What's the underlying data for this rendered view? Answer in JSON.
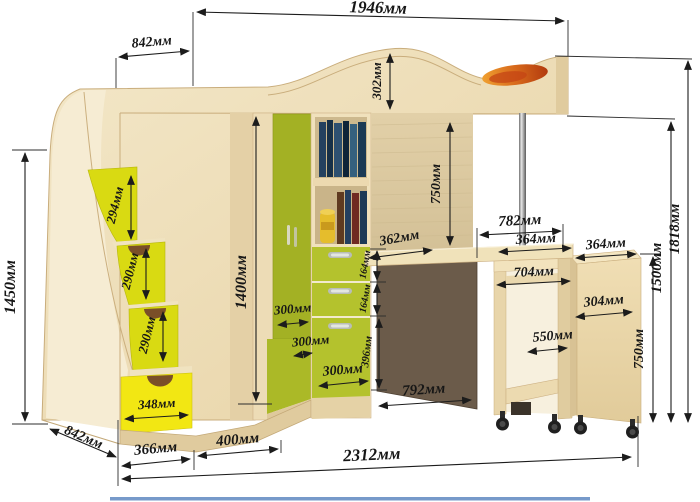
{
  "dims": {
    "top_width": "1946мм",
    "top_depth": "842мм",
    "headboard_height": "302мм",
    "stairs_height": "1450мм",
    "step1_height": "294мм",
    "step2_height": "290мм",
    "step3_height": "290мм",
    "bottom_drawer_width": "348мм",
    "bottom_depth": "842мм",
    "stairs_width": "366мм",
    "corner_width": "400мм",
    "wardrobe_height": "1400мм",
    "corner_face1": "300мм",
    "corner_face2": "300мм",
    "corner_face3": "300мм",
    "drawer1_height": "164мм",
    "drawer2_height": "164мм",
    "drawer3_height": "396мм",
    "desk_depth": "362мм",
    "underbed_clearance": "750мм",
    "desk_width": "782мм",
    "desk_section": "364мм",
    "cabinet_top_depth": "364мм",
    "mobile_desk_width": "704мм",
    "cabinet_depth": "304мм",
    "shelf_width": "550мм",
    "cabinet_height": "750мм",
    "bed_height": "1500мм",
    "total_height": "1818мм",
    "under_desk_width": "792мм",
    "total_width": "2312мм"
  },
  "colors": {
    "wood": "#eedfbd",
    "wood_light": "#f6ecd3",
    "wood_dark": "#d8c294",
    "green_door": "#a3b124",
    "green_lower": "#abb927",
    "green_drawer": "#b4c22d",
    "step_yellow": "#d9da12",
    "drawer_yellow": "#f2e713",
    "dark_panel": "#6b5b4a",
    "orange_accent": "#d86a1c",
    "dim_color": "#1c1c1c",
    "footer_line": "#5f88c1"
  }
}
